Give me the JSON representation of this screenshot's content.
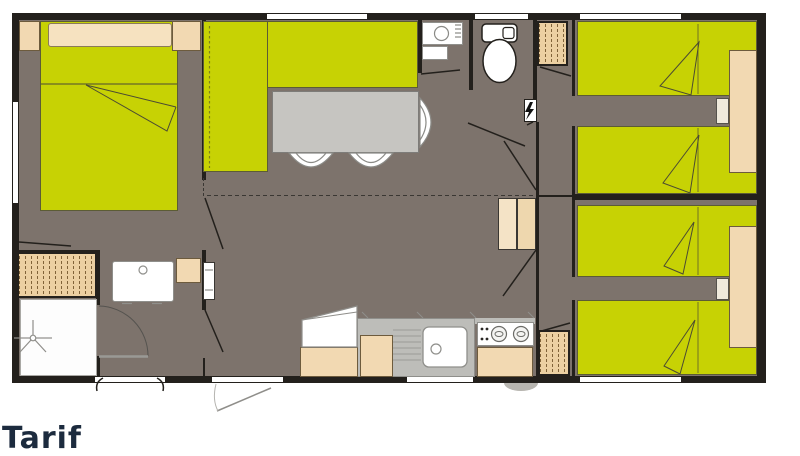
{
  "watermark": {
    "text": "Tarif"
  },
  "palette": {
    "wall": "#23201c",
    "floor": "#7d736c",
    "green": "#c7d204",
    "beige": "#f2d9b2",
    "pillow": "#f6e2c0",
    "hatch": "#ecd0a2",
    "tableGray": "#c6c5c1",
    "counterGray": "#bdbdb9",
    "white": "#ffffff",
    "watermark": "#1c2b3e"
  },
  "plan": {
    "type": "mobile-home-floorplan",
    "rooms": [
      "master-bedroom",
      "living-room",
      "washbasin-room",
      "wc",
      "twin-bedroom-top",
      "twin-bedroom-bottom",
      "bathroom",
      "kitchen",
      "hallway"
    ],
    "furniture": {
      "double_bed": 1,
      "single_beds": 4,
      "corner_sofa": 1,
      "dining_table": 1,
      "chairs": 3,
      "wardrobes": 3,
      "nightstands": 2,
      "toilet": 1,
      "washbasins": 3,
      "shower": 1,
      "kitchen_sink": 1,
      "hob_burners": 2,
      "fridge": 1,
      "electrical_panel": 1
    },
    "icons": {
      "electrical_panel": "lightning-bolt-icon",
      "shower": "shower-head-icon"
    }
  }
}
